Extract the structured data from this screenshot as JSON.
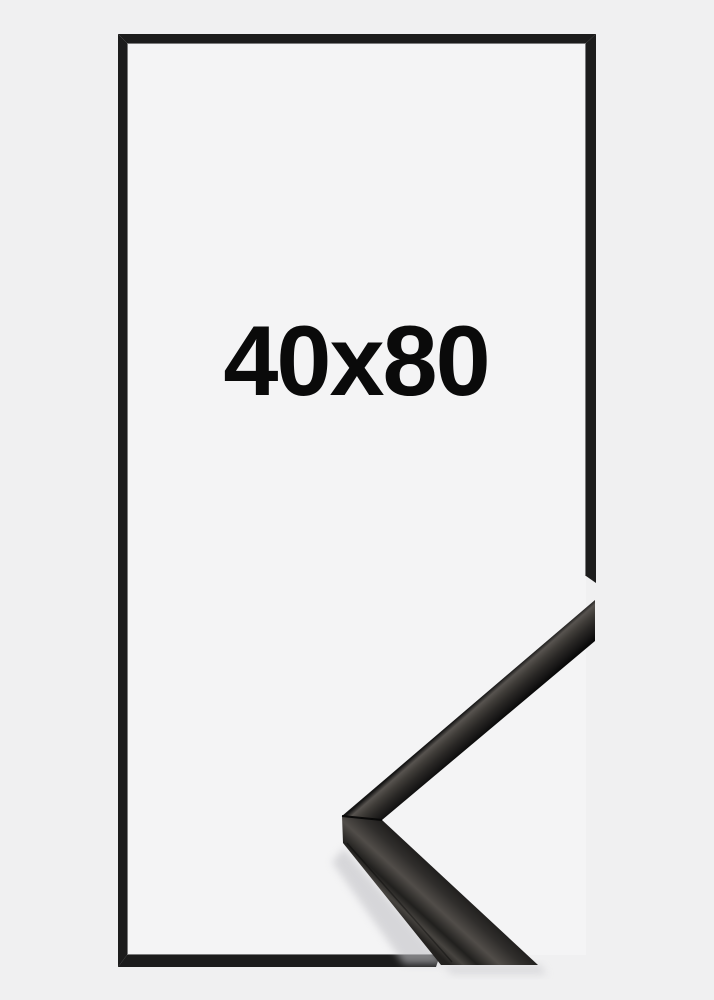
{
  "page": {
    "background_color": "#f0f0f1"
  },
  "product": {
    "size_label": "40x80",
    "frame_style": "thin black frame outline with glossy black corner profile detail"
  },
  "colors": {
    "page-bg": "#f0f0f1",
    "frame-color": "#1c1c1c",
    "label-color": "#0a0a0a",
    "inner-bg": "#f4f4f5"
  }
}
